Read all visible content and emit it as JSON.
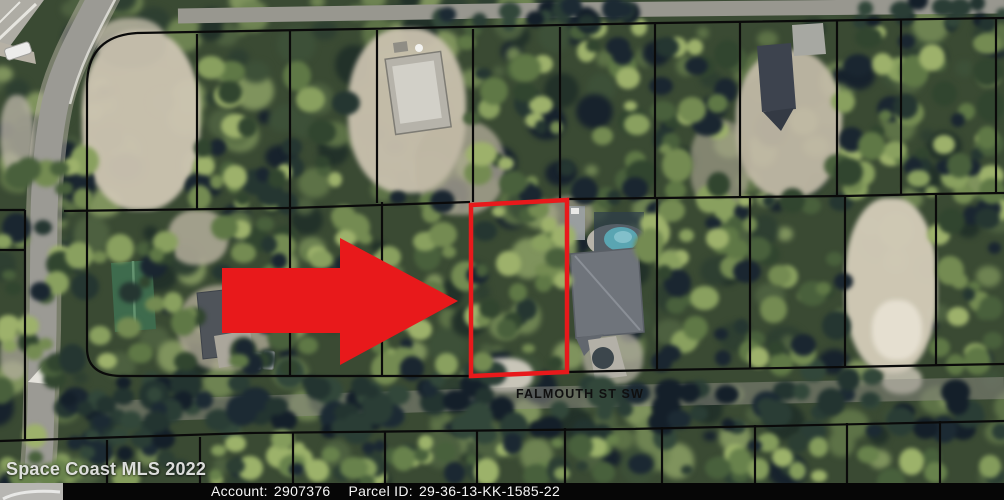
{
  "map": {
    "street_label": "FALMOUTH ST SW",
    "watermark": "Space Coast MLS 2022"
  },
  "footer": {
    "account_label": "Account:",
    "account_value": "2907376",
    "parcel_id_label": "Parcel ID:",
    "parcel_id_value": "29-36-13-KK-1585-22"
  },
  "colors": {
    "highlight_red": "#e8191b",
    "boundary_black": "#0a0a0a",
    "pool_teal": "#5aa5b2",
    "footer_bg": "#060606",
    "footer_text": "#f7f7f7",
    "street_label_color": "#101010",
    "watermark_color": "#e9e9e9",
    "road_gray": "#9b9a94",
    "sand": "#cdc5b2",
    "tree_palette_base": [
      "#17222c",
      "#223129",
      "#2e3f31",
      "#3d5038",
      "#4d6040",
      "#5d7247",
      "#6e8352",
      "#7f935d"
    ],
    "tree_palette_canopy": [
      "#1a2630",
      "#253631",
      "#31452f",
      "#49603c",
      "#5f7846",
      "#748b52",
      "#89a05f",
      "#9db16b"
    ],
    "tree_palette_dark": [
      "#141f29",
      "#1c2a33",
      "#233430",
      "#2a3d35",
      "#32473a"
    ],
    "tree_palette_light": [
      "#1b2832",
      "#2c3e33",
      "#48603c",
      "#68824c",
      "#849c5c",
      "#9cb26a"
    ]
  }
}
